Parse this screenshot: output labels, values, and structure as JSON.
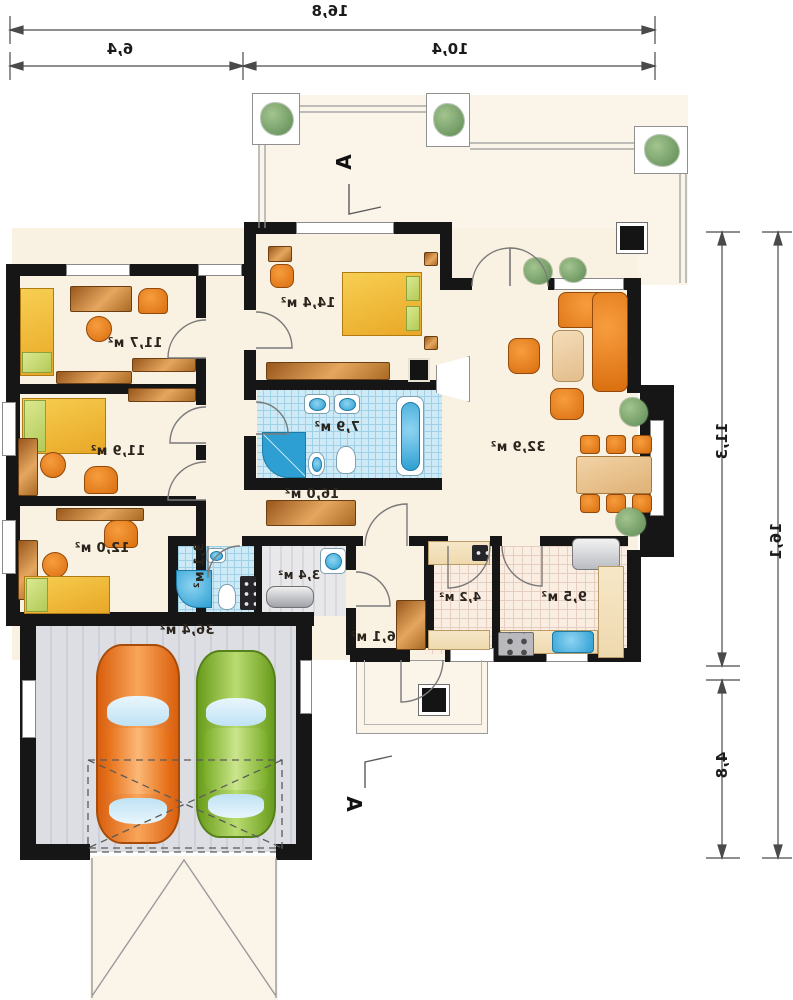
{
  "plan": {
    "title_hint": "mirrored bungalow floor plan",
    "dims": {
      "top_total": "16,8",
      "top_left": "6,4",
      "top_right": "10,4",
      "right_upper": "11,3",
      "right_lower": "4,8",
      "right_total": "16,1"
    },
    "section": {
      "top": "A",
      "bottom": "A"
    },
    "rooms": {
      "bedroom1": "11,7 м²",
      "bedroom2": "11,9 м²",
      "bedroom3": "12,0 м²",
      "master_bedroom": "14,4 м²",
      "bathroom": "7,9 м²",
      "hall": "16,0 м²",
      "living_room": "32,9 м²",
      "wc": "3,1 м²",
      "utility": "3,4 м²",
      "pantry": "4,2 м²",
      "kitchen": "9,5 м²",
      "entry": "6,1 м²",
      "garage": "36,4 м²"
    },
    "colors": {
      "wall": "#161616",
      "floor": "#f9f1e1",
      "bath_tile": "#cdeaf6",
      "kitchen_tile": "#faeee2",
      "furniture_wood": "#c07a33",
      "furniture_orange": "#e8821e",
      "bed_yellow": "#f2bc33",
      "pillow_green": "#c3d96f",
      "fixture_blue": "#2d9fd2",
      "garage_floor": "#dcdee3",
      "car_orange": "#ef7e27",
      "car_green": "#8cc43c",
      "plant_green": "#6f9a63",
      "line_gray": "#8f8f8f"
    }
  }
}
